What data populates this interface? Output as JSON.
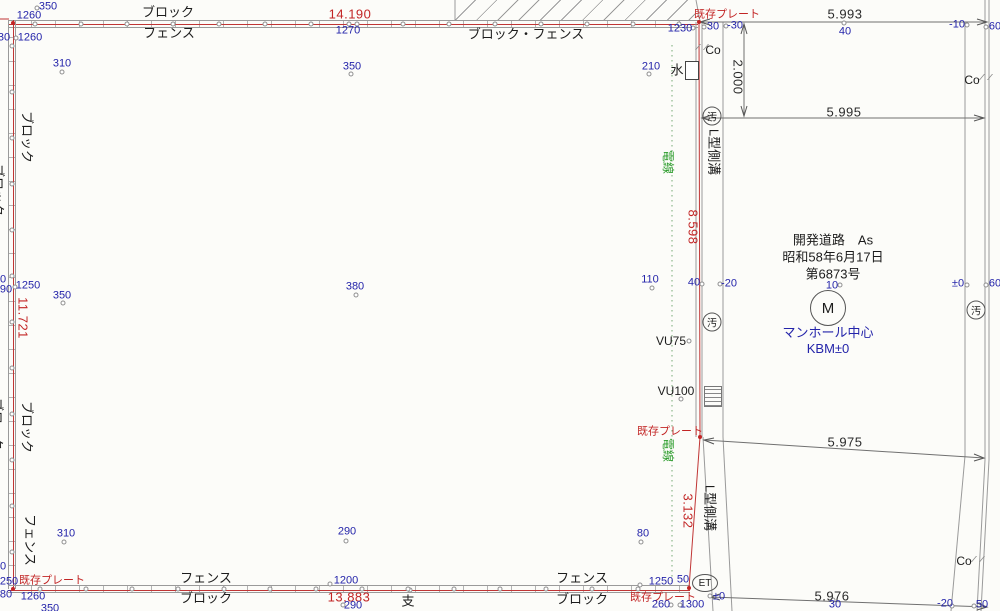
{
  "drawing": {
    "colors": {
      "boundary_red": "#c03535",
      "point_blue": "#2424aa",
      "wire_green": "#2f9e2f",
      "line_grey": "#9a9a9a",
      "text_black": "#1c1c1c"
    },
    "red_dimensions": [
      {
        "t": "14.190",
        "x": 350,
        "y": 14
      },
      {
        "t": "13.883",
        "x": 349,
        "y": 597
      },
      {
        "t": "11.721",
        "x": 23,
        "y": 318,
        "r": 90
      },
      {
        "t": "8.598",
        "x": 693,
        "y": 227,
        "r": 90
      },
      {
        "t": "3.132",
        "x": 688,
        "y": 511,
        "r": 90
      }
    ],
    "black_dimensions": [
      {
        "t": "5.993",
        "x": 845,
        "y": 14
      },
      {
        "t": "5.995",
        "x": 844,
        "y": 112
      },
      {
        "t": "5.975",
        "x": 845,
        "y": 442
      },
      {
        "t": "5.976",
        "x": 832,
        "y": 596
      },
      {
        "t": "2.000",
        "x": 738,
        "y": 77,
        "r": 90
      }
    ],
    "plate_labels": [
      {
        "t": "既存プレート",
        "x": 727,
        "y": 15
      },
      {
        "t": "既存プレート",
        "x": 670,
        "y": 432
      },
      {
        "t": "既存プレート",
        "x": 52,
        "y": 581
      },
      {
        "t": "既存プレート",
        "x": 663,
        "y": 598
      }
    ],
    "wall_labels": [
      {
        "t": "ブロック",
        "x": 168,
        "y": 12
      },
      {
        "t": "フェンス",
        "x": 169,
        "y": 33
      },
      {
        "t": "ブロック・フェンス",
        "x": 526,
        "y": 34
      },
      {
        "t": "フェンス",
        "x": 206,
        "y": 578
      },
      {
        "t": "ブロック",
        "x": 206,
        "y": 598
      },
      {
        "t": "フェンス",
        "x": 582,
        "y": 578
      },
      {
        "t": "ブロック",
        "x": 582,
        "y": 599
      },
      {
        "t": "ブロック",
        "x": 27,
        "y": 137,
        "r": 90
      },
      {
        "t": "ブロック",
        "x": -2,
        "y": 190,
        "r": 90
      },
      {
        "t": "ブロック",
        "x": 27,
        "y": 427,
        "r": 90
      },
      {
        "t": "ブロック",
        "x": -3,
        "y": 424,
        "r": 90
      },
      {
        "t": "フェンス",
        "x": 30,
        "y": 540,
        "r": 90
      }
    ],
    "road_labels": [
      {
        "t": "L型側溝",
        "x": 714,
        "y": 152,
        "r": 90
      },
      {
        "t": "L型側溝",
        "x": 710,
        "y": 508,
        "r": 90
      },
      {
        "t": "Co",
        "x": 713,
        "y": 50,
        "sm": 1
      },
      {
        "t": "Co",
        "x": 972,
        "y": 80,
        "sm": 1
      },
      {
        "t": "Co",
        "x": 964,
        "y": 561,
        "sm": 1
      },
      {
        "t": "水",
        "x": 677,
        "y": 70
      },
      {
        "t": "VU75",
        "x": 671,
        "y": 341,
        "sm": 1
      },
      {
        "t": "VU100",
        "x": 676,
        "y": 391,
        "sm": 1
      },
      {
        "t": "支",
        "x": 408,
        "y": 601
      }
    ],
    "wire_labels": [
      {
        "t": "電線",
        "x": 668,
        "y": 162,
        "r": 90
      },
      {
        "t": "電線",
        "x": 668,
        "y": 450,
        "r": 90
      }
    ],
    "road_note": [
      "開発道路　As",
      "昭和58年6月17日",
      "第6873号"
    ],
    "manhole_note": [
      "マンホール中心",
      "KBM±0"
    ],
    "circled_labels": [
      {
        "t": "M",
        "x": 828,
        "y": 308,
        "w": 34,
        "h": 34,
        "fs": 15
      },
      {
        "t": "ET",
        "x": 705,
        "y": 583,
        "w": 24,
        "h": 16,
        "fs": 10
      },
      {
        "t": "汚",
        "x": 712,
        "y": 116,
        "w": 17,
        "h": 17,
        "fs": 10
      },
      {
        "t": "汚",
        "x": 712,
        "y": 322,
        "w": 17,
        "h": 17,
        "fs": 10
      },
      {
        "t": "汚",
        "x": 976,
        "y": 310,
        "w": 17,
        "h": 17,
        "fs": 10
      }
    ],
    "points": [
      {
        "t": "350",
        "x": 48,
        "y": 7,
        "cx": 37,
        "cy": 8
      },
      {
        "t": "1260",
        "x": 29,
        "y": 16
      },
      {
        "t": "30",
        "x": 4,
        "y": 38
      },
      {
        "t": "1260",
        "x": 30,
        "y": 38,
        "cx": 16,
        "cy": 38
      },
      {
        "t": "310",
        "x": 62,
        "y": 64,
        "cx": 62,
        "cy": 72
      },
      {
        "t": "1270",
        "x": 348,
        "y": 31,
        "cx": 349,
        "cy": 24
      },
      {
        "t": "350",
        "x": 352,
        "y": 67,
        "cx": 351,
        "cy": 74
      },
      {
        "t": "1230",
        "x": 680,
        "y": 29,
        "cx": 693,
        "cy": 28
      },
      {
        "t": "210",
        "x": 651,
        "y": 67,
        "cx": 649,
        "cy": 74
      },
      {
        "t": "30",
        "x": 713,
        "y": 27,
        "cx": 704,
        "cy": 27
      },
      {
        "t": "-30",
        "x": 735,
        "y": 26,
        "cx": 726,
        "cy": 26
      },
      {
        "t": "40",
        "x": 845,
        "y": 32,
        "cx": 844,
        "cy": 23
      },
      {
        "t": "-10",
        "x": 957,
        "y": 25,
        "cx": 967,
        "cy": 25
      },
      {
        "t": "60",
        "x": 995,
        "y": 27,
        "cx": 986,
        "cy": 27
      },
      {
        "t": "0",
        "x": 3,
        "y": 280
      },
      {
        "t": "90",
        "x": 6,
        "y": 290
      },
      {
        "t": "1250",
        "x": 28,
        "y": 286,
        "cx": 15,
        "cy": 287
      },
      {
        "t": "350",
        "x": 62,
        "y": 296,
        "cx": 63,
        "cy": 303
      },
      {
        "t": "380",
        "x": 355,
        "y": 287,
        "cx": 356,
        "cy": 295
      },
      {
        "t": "110",
        "x": 650,
        "y": 280,
        "cx": 652,
        "cy": 288
      },
      {
        "t": "40",
        "x": 694,
        "y": 283,
        "cx": 702,
        "cy": 284
      },
      {
        "t": "-20",
        "x": 729,
        "y": 284,
        "cx": 720,
        "cy": 284
      },
      {
        "t": "10",
        "x": 832,
        "y": 286,
        "cx": 840,
        "cy": 285
      },
      {
        "t": "±0",
        "x": 958,
        "y": 284,
        "cx": 967,
        "cy": 285
      },
      {
        "t": "60",
        "x": 995,
        "y": 284,
        "cx": 986,
        "cy": 285
      },
      {
        "t": "310",
        "x": 66,
        "y": 534,
        "cx": 64,
        "cy": 542
      },
      {
        "t": "290",
        "x": 347,
        "y": 532,
        "cx": 346,
        "cy": 541
      },
      {
        "t": "80",
        "x": 643,
        "y": 534,
        "cx": 641,
        "cy": 542
      },
      {
        "t": "1200",
        "x": 346,
        "y": 581,
        "cx": 330,
        "cy": 584
      },
      {
        "t": "1250",
        "x": 661,
        "y": 582,
        "cx": 640,
        "cy": 585
      },
      {
        "t": "50",
        "x": 683,
        "y": 580
      },
      {
        "t": "±0",
        "x": 719,
        "y": 597,
        "cx": 710,
        "cy": 596
      },
      {
        "t": "260",
        "x": 661,
        "y": 605,
        "cx": 671,
        "cy": 605
      },
      {
        "t": "1300",
        "x": 692,
        "y": 605,
        "cx": 680,
        "cy": 605
      },
      {
        "t": "30",
        "x": 835,
        "y": 605,
        "cx": 833,
        "cy": 600
      },
      {
        "t": "-20",
        "x": 945,
        "y": 604,
        "cx": 952,
        "cy": 606
      },
      {
        "t": "50",
        "x": 982,
        "y": 605,
        "cx": 974,
        "cy": 606
      },
      {
        "t": "290",
        "x": 353,
        "y": 606,
        "cx": 343,
        "cy": 605
      },
      {
        "t": "1260",
        "x": 33,
        "y": 597
      },
      {
        "t": "250",
        "x": 9,
        "y": 582
      },
      {
        "t": "0",
        "x": 3,
        "y": 567
      },
      {
        "t": "80",
        "x": 6,
        "y": 595
      },
      {
        "t": "350",
        "x": 50,
        "y": 609
      }
    ],
    "small_circles": [
      {
        "x": 689,
        "y": 341
      },
      {
        "x": 681,
        "y": 399
      },
      {
        "x": 410,
        "y": 590
      }
    ],
    "boundary_points": [
      {
        "x": 13,
        "y": 23
      },
      {
        "x": 699,
        "y": 22
      },
      {
        "x": 700,
        "y": 437
      },
      {
        "x": 689,
        "y": 588
      },
      {
        "x": 13,
        "y": 589
      }
    ]
  }
}
